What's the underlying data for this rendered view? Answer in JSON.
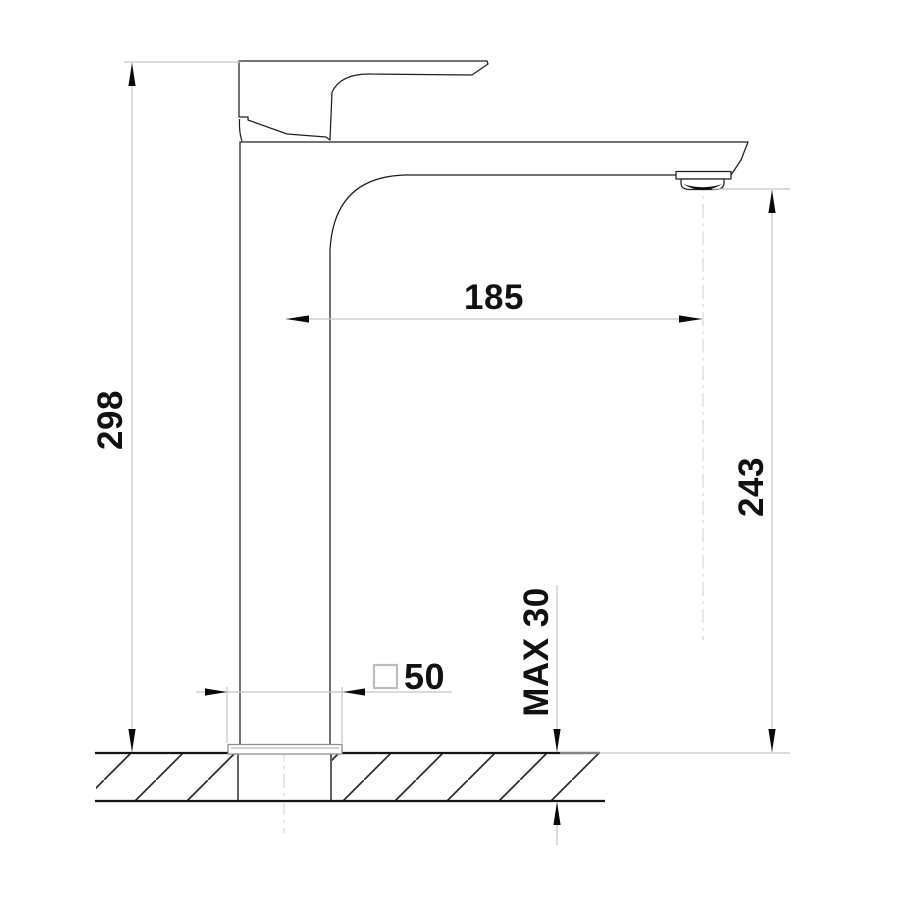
{
  "drawing": {
    "subject": "Tall single-lever basin mixer tap - side elevation with installation dimensions",
    "units": "mm",
    "labels": {
      "height_overall": "298",
      "spout_reach": "185",
      "outlet_height": "243",
      "base_size": "50",
      "deck_max": "MAX 30"
    },
    "symbols": {
      "square_section_symbol": "square-outline prefix before base size 50"
    },
    "colors": {
      "outline": "#1f1f1f",
      "dimension_line": "#c5c5c5",
      "centerline": "#cfcfcf",
      "arrow": "#0a0a0a",
      "text": "#111111",
      "hatch": "#2a2a2a",
      "background": "#ffffff"
    }
  }
}
